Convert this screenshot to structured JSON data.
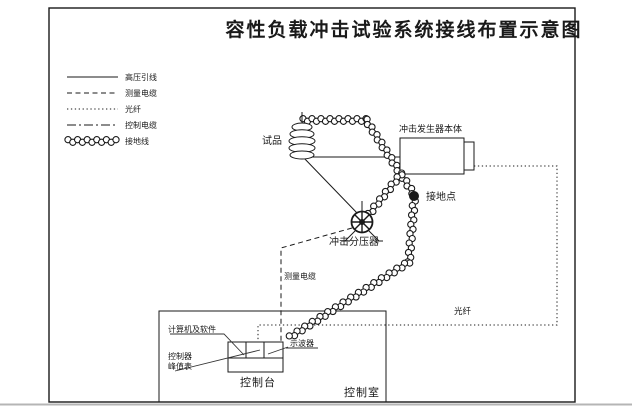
{
  "title": "容性负载冲击试验系统接线布置示意图",
  "legend": {
    "items": [
      {
        "style": "solid",
        "label": "高压引线"
      },
      {
        "style": "dashed",
        "label": "测量电缆"
      },
      {
        "style": "dotted",
        "label": "光纤"
      },
      {
        "style": "dashdot",
        "label": "控制电缆"
      },
      {
        "style": "braid",
        "label": "接地线"
      }
    ]
  },
  "diagram": {
    "test_object": "试品",
    "impulse_generator": "冲击发生器本体",
    "ground_point": "接地点",
    "impulse_divider": "冲击分压器",
    "measuring_cable": "测量电缆",
    "optical_fiber": "光纤",
    "oscilloscope": "示波器",
    "computer_software": "计算机及软件",
    "controller": "控制器",
    "peak_meter": "峰值表",
    "control_console": "控制台",
    "control_room": "控制室"
  },
  "colors": {
    "line": "#1a1a1a",
    "background": "#ffffff"
  }
}
